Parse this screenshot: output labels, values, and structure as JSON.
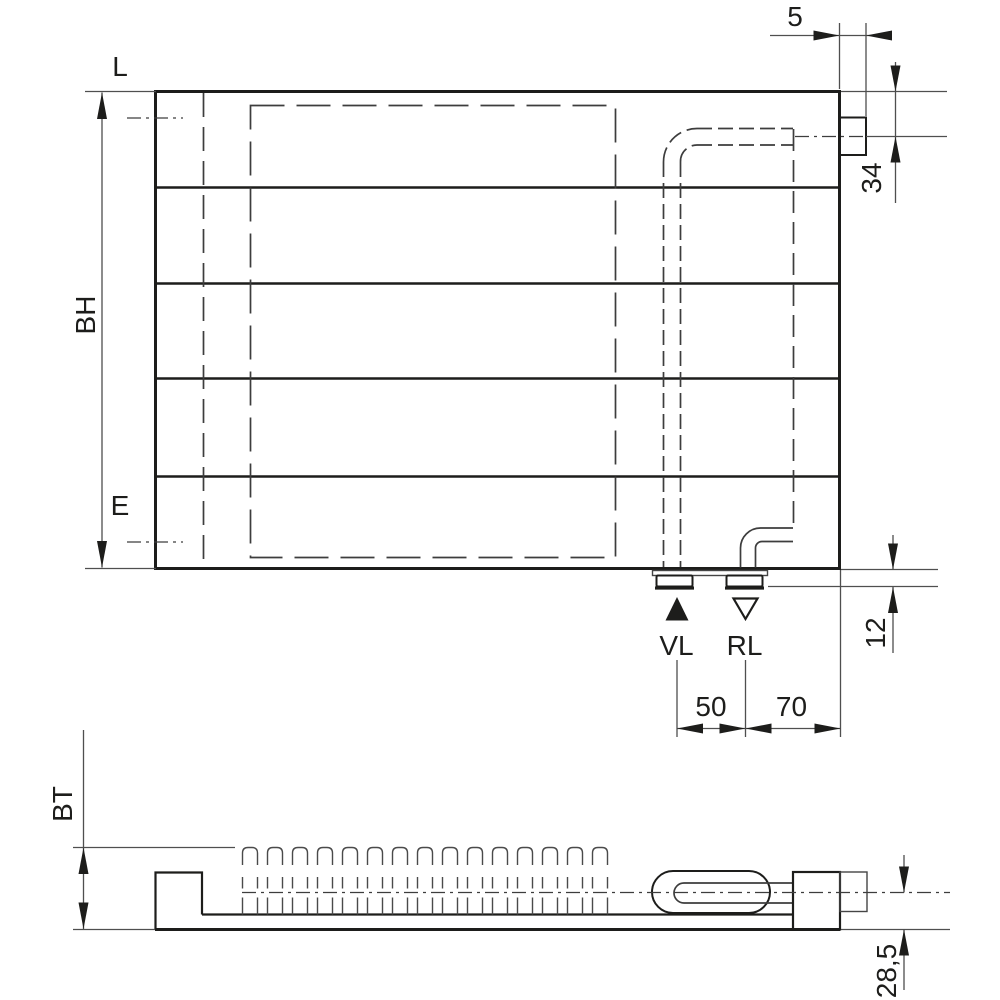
{
  "drawing_title": "radiator dimensional drawing",
  "colors": {
    "background": "#ffffff",
    "outline": "#1d1d1b",
    "hidden_line": "#3d3d3d",
    "dimension_line": "#4f4f4f",
    "text": "#1d1d1b"
  },
  "front_view": {
    "labels": {
      "length": "L",
      "build_height": "BH",
      "connection_height": "E",
      "supply": "VL",
      "return_flow": "RL"
    },
    "dimensions": {
      "side_connection_offset": "5",
      "side_connection_center": "34",
      "stub_protrusion": "12",
      "supply_return_spacing": "50",
      "return_to_edge": "70"
    }
  },
  "profile_view": {
    "labels": {
      "build_depth": "BT"
    },
    "dimensions": {
      "pipe_axis_to_bottom": "28,5"
    }
  }
}
